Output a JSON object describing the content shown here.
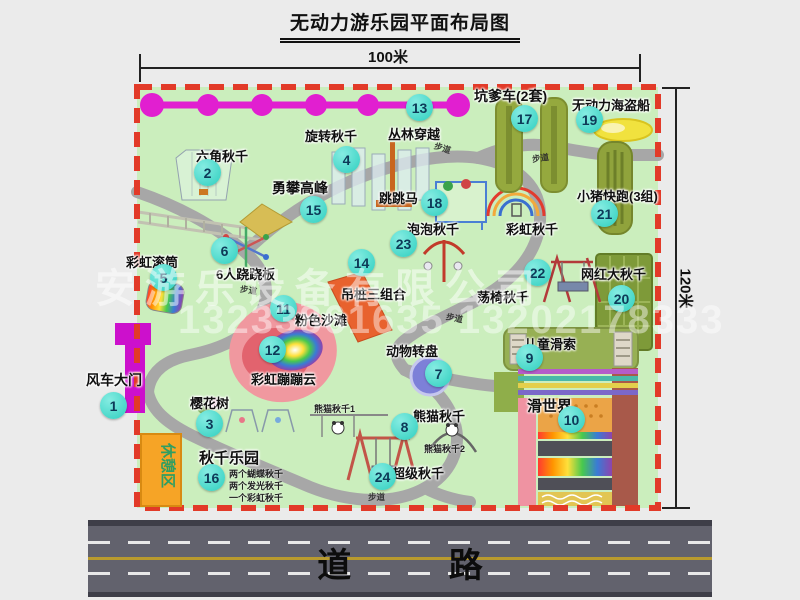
{
  "title": "无动力游乐园平面布局图",
  "dim": {
    "w": "100米",
    "h": "120米"
  },
  "watermark": {
    "company": "安游乐设备有限公司",
    "phone": "13233861635 13202178333"
  },
  "road_label": "道 路",
  "rest_label": "休憩区",
  "walkway": "步道",
  "rainbow_swing": "彩虹秋千",
  "attractions": [
    {
      "num": "1",
      "name": "风车大门"
    },
    {
      "num": "2",
      "name": "六角秋千"
    },
    {
      "num": "3",
      "name": "樱花树"
    },
    {
      "num": "4",
      "name": "旋转秋千"
    },
    {
      "num": "5",
      "name": "彩虹滚筒"
    },
    {
      "num": "6",
      "name": "6人跷跷板"
    },
    {
      "num": "7",
      "name": "动物转盘"
    },
    {
      "num": "8",
      "name": "熊猫秋千",
      "subs": [
        "熊猫秋千1",
        "熊猫秋千2"
      ]
    },
    {
      "num": "9",
      "name": "儿童滑索"
    },
    {
      "num": "10",
      "name": "滑世界"
    },
    {
      "num": "11",
      "name": "粉色沙滩"
    },
    {
      "num": "12",
      "name": "彩虹蹦蹦云"
    },
    {
      "num": "13",
      "name": "丛林穿越"
    },
    {
      "num": "14",
      "name": "吊桩三组合"
    },
    {
      "num": "15",
      "name": "勇攀高峰"
    },
    {
      "num": "16",
      "name": "秋千乐园",
      "subs": [
        "两个蝴蝶秋千",
        "两个发光秋千",
        "一个彩虹秋千"
      ]
    },
    {
      "num": "17",
      "name": "坑爹车(2套)"
    },
    {
      "num": "18",
      "name": "跳跳马"
    },
    {
      "num": "19",
      "name": "无动力海盗船"
    },
    {
      "num": "20",
      "name": "网红大秋千"
    },
    {
      "num": "21",
      "name": "小猪快跑(3组)"
    },
    {
      "num": "22",
      "name": "荡椅秋千"
    },
    {
      "num": "23",
      "name": "泡泡秋千"
    },
    {
      "num": "24",
      "name": "超级秋千"
    }
  ],
  "colors": {
    "park_green": "#cbeebd",
    "boundary_red": "#e23a28",
    "zipline_magenta": "#e11fd0",
    "badge_cyan": "#2fcfbf",
    "path_gray": "#a7a7a7",
    "road_gray": "#62626d",
    "rest_orange": "#f6a426"
  }
}
